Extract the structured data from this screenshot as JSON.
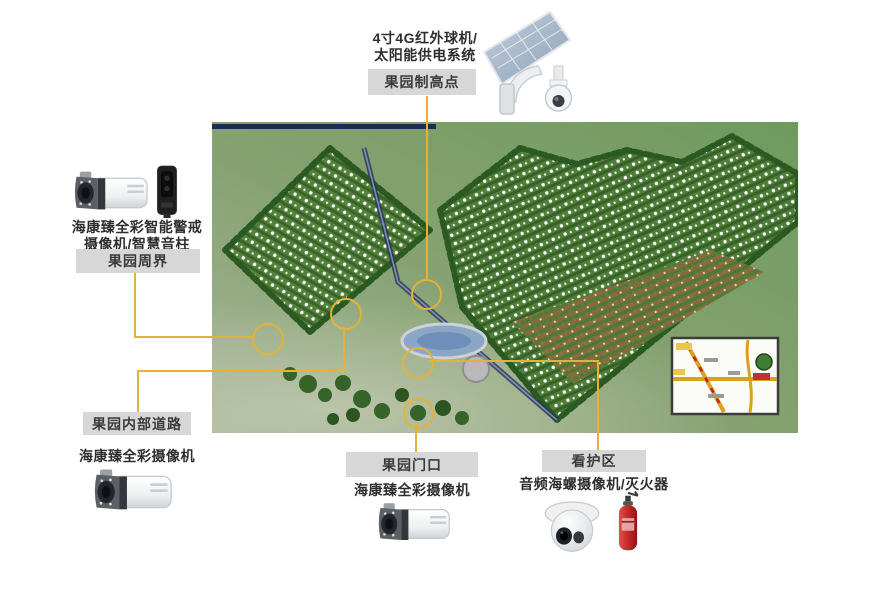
{
  "colors": {
    "accent": "#e3b23a",
    "label_box_bg": "#d7d7d7",
    "label_text": "#3b3b3b",
    "navy_bar": "#1c2a56"
  },
  "callouts": {
    "high_point": {
      "device_label_line1": "4寸4G红外球机/",
      "device_label_line2": "太阳能供电系统",
      "zone_label": "果园制高点",
      "icon": "solar-panel-ptz-camera-icon"
    },
    "perimeter": {
      "device_label_line1": "海康臻全彩智能警戒",
      "device_label_line2": "摄像机/智慧音柱",
      "zone_label": "果园周界",
      "icons": [
        "bullet-camera-icon",
        "smart-speaker-column-icon"
      ]
    },
    "internal_road": {
      "zone_label": "果园内部道路",
      "device_label": "海康臻全彩摄像机",
      "icon": "bullet-camera-icon"
    },
    "gate": {
      "zone_label": "果园门口",
      "device_label": "海康臻全彩摄像机",
      "icon": "bullet-camera-icon"
    },
    "care_area": {
      "zone_label": "看护区",
      "device_label": "音频海螺摄像机/灭火器",
      "icons": [
        "turret-camera-icon",
        "fire-extinguisher-icon"
      ]
    }
  }
}
